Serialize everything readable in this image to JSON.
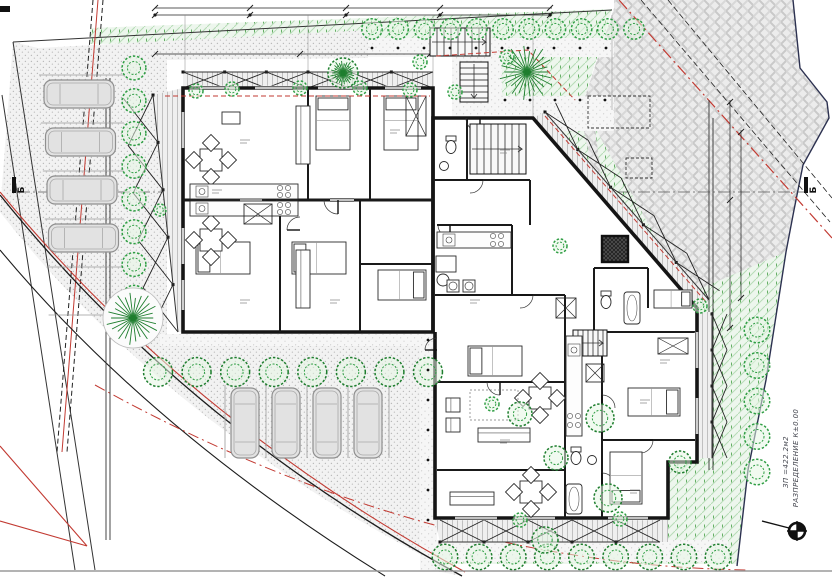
{
  "annotations": {
    "axis_left": "Б",
    "axis_right": "Б",
    "title_line1": "РАЗПРЕДЕЛЕНИЕ К±0.00",
    "title_line2": "ЗП =422.2м2"
  },
  "site": {
    "zones": {
      "lawn_hatch_color": "#8fc98f",
      "lawn_bg": "#edf6ed",
      "pavement_dot_color": "#b9b9b9",
      "pavement_bg": "#f2f2f2",
      "neighbor_weave_color": "#c9c9c9",
      "neighbor_bg": "#ececec",
      "wall_color": "#151515",
      "boundary_red": "#c23a32",
      "parcel_navy": "#2c3150",
      "tree_green": "#2f9e44",
      "tree_dark_green": "#1e7e2e"
    },
    "parking": {
      "left_column_cars": 4,
      "bottom_row_cars": 4
    },
    "symbols": {
      "north_benchmark": "circle-cross-benchmark",
      "axis_flag": "filled-bar"
    }
  }
}
